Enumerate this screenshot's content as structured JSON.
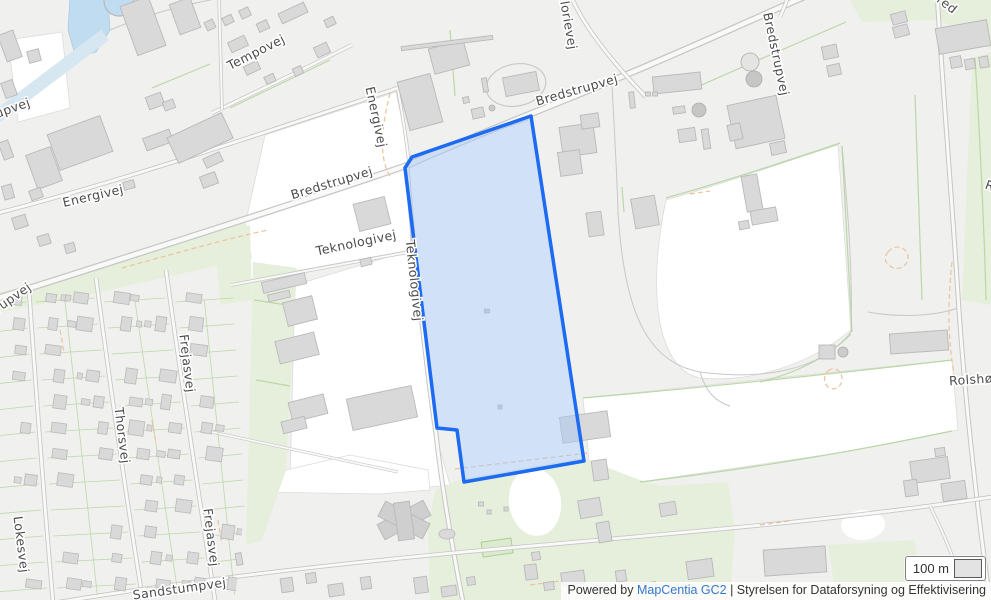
{
  "map": {
    "street_labels": [
      {
        "text": "upvej",
        "x": 14,
        "y": 112,
        "rot": -20
      },
      {
        "text": "Tempovej",
        "x": 258,
        "y": 56,
        "rot": -27
      },
      {
        "text": "Energivej",
        "x": 372,
        "y": 118,
        "rot": 78
      },
      {
        "text": "Energivej",
        "x": 94,
        "y": 200,
        "rot": -13
      },
      {
        "text": "Bredstrupvej",
        "x": 578,
        "y": 94,
        "rot": -16
      },
      {
        "text": "Bredstrupvej",
        "x": 333,
        "y": 187,
        "rot": -17
      },
      {
        "text": "Bredstrupvej",
        "x": 772,
        "y": 55,
        "rot": 78
      },
      {
        "text": "Bred",
        "x": 941,
        "y": 5,
        "rot": 38
      },
      {
        "text": "Teknologivej",
        "x": 357,
        "y": 247,
        "rot": -12
      },
      {
        "text": "Teknologivej",
        "x": 410,
        "y": 281,
        "rot": 84
      },
      {
        "text": "Kalorievej",
        "x": 563,
        "y": 18,
        "rot": 80
      },
      {
        "text": "Frejasvej",
        "x": 183,
        "y": 364,
        "rot": 83
      },
      {
        "text": "Thorsvej",
        "x": 118,
        "y": 436,
        "rot": 83
      },
      {
        "text": "Lokesvej",
        "x": 17,
        "y": 545,
        "rot": 83
      },
      {
        "text": "Frejasvej",
        "x": 207,
        "y": 538,
        "rot": 83
      },
      {
        "text": "Sandstumpvej",
        "x": 180,
        "y": 593,
        "rot": -8
      },
      {
        "text": "rupvej",
        "x": 15,
        "y": 301,
        "rot": -35
      },
      {
        "text": "Rolshøjvej",
        "x": 983,
        "y": 383,
        "rot": -4
      },
      {
        "text": "Ro",
        "x": 992,
        "y": 191,
        "rot": 20
      }
    ],
    "selected_parcel": {
      "ring": [
        [
          531,
          116
        ],
        [
          584,
          461
        ],
        [
          464,
          482
        ],
        [
          457,
          430
        ],
        [
          437,
          428
        ],
        [
          405,
          168
        ],
        [
          412,
          157
        ]
      ],
      "stroke": "#1d6bf2",
      "fill": "#aac9f3",
      "fill_opacity": 0.55
    },
    "colors": {
      "background": "#f0f0ee",
      "field_white": "#ffffff",
      "green_area": "#e6efdb",
      "water": "#bfdcf1",
      "building_fill": "#d9d9d9",
      "building_stroke": "#b9b9b9",
      "road_casing": "#c6c6c6",
      "road_fill": "#f9f9f7",
      "boundary_green": "#b5d49e",
      "boundary_orange": "#ecc39b",
      "label_color": "#4c4c4c",
      "link_color": "#3579c8"
    },
    "scale_bar": {
      "label": "100 m"
    },
    "attribution": {
      "powered_by": "Powered by ",
      "link_label": "MapCentia GC2",
      "separator": " | ",
      "agency": "Styrelsen for Dataforsyning og Effektivisering"
    }
  }
}
